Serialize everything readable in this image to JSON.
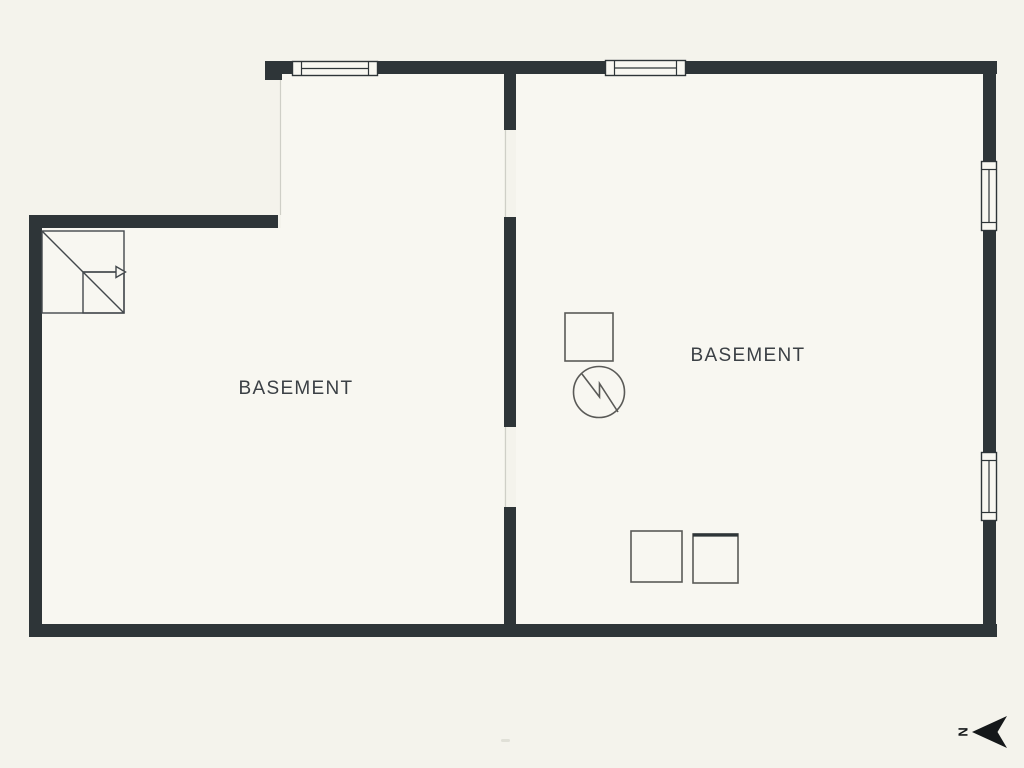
{
  "title": "Basement floor plan",
  "rooms": [
    {
      "label": "BASEMENT",
      "side": "left"
    },
    {
      "label": "BASEMENT",
      "side": "right"
    }
  ],
  "compass": {
    "label": "N",
    "arrow_icon": "north-arrow-pointing-left"
  },
  "symbols": [
    {
      "name": "staircase-icon",
      "location": "upper-left"
    },
    {
      "name": "water-heater-icon",
      "location": "center"
    },
    {
      "name": "utility-square-icon",
      "location": "center-above-heater"
    },
    {
      "name": "appliance-square-icon",
      "location": "lower-center-left"
    },
    {
      "name": "appliance-square-icon",
      "location": "lower-center-right"
    },
    {
      "name": "window-icon",
      "count": 4
    }
  ],
  "colors": {
    "background": "#f4f3ec",
    "floor": "#f8f7f1",
    "wall": "#2e3538",
    "fixture": "#5a5a57",
    "stair": "#43484c",
    "text": "#3b4045",
    "faint": "#cfcfc7",
    "arrow": "#15181a"
  }
}
